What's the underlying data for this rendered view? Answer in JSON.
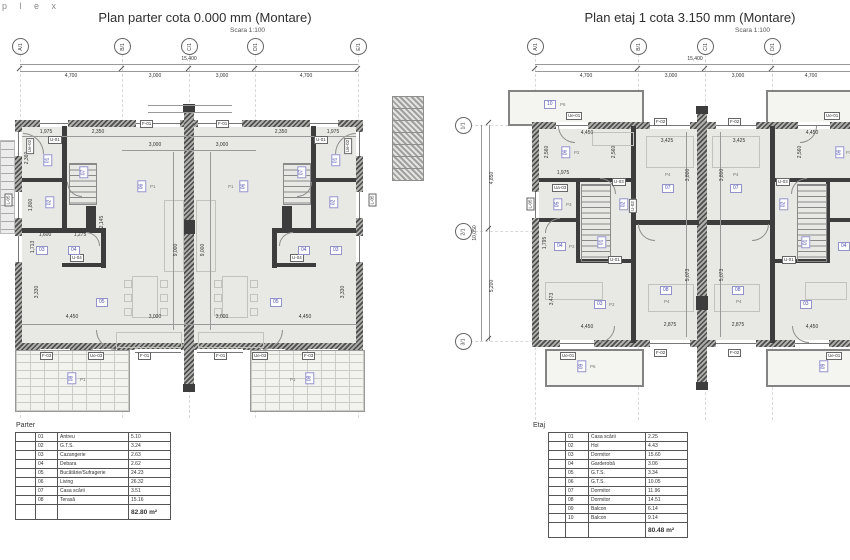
{
  "logo": "p l e x",
  "parter": {
    "title": "Plan parter cota 0.000 mm (Montare)",
    "scale": "Scara 1:100",
    "grid_letters": [
      "A/1",
      "B/1",
      "C/1",
      "D/1",
      "E/1"
    ],
    "total_dim": "15,400",
    "span_dims": [
      "4,700",
      "3,000",
      "3,000",
      "4,700"
    ],
    "top_dims": [
      "1,975",
      "2,350",
      "2,350",
      "1,975"
    ],
    "mid_dims": [
      "3,000",
      "3,000"
    ],
    "bottom_dims": [
      "4,450",
      "3,000",
      "3,000",
      "4,450"
    ],
    "v_dims": {
      "nine": "9,000",
      "t3330": "3,330",
      "t2360": "2,360",
      "t1800": "1,800",
      "t1713": "1,713",
      "t2145": "2,145"
    },
    "small_dims": [
      "1,600",
      "1,275"
    ],
    "tags": {
      "f01": "F-01",
      "f03": "F-03",
      "ue03": "Ue-03",
      "ue02": "Ue-02",
      "l05": "L-05",
      "u01": "U-01",
      "u04": "U-04"
    },
    "rooms": [
      "01",
      "02",
      "03",
      "04",
      "05",
      "06",
      "07",
      "08"
    ],
    "p1": "P1"
  },
  "etaj": {
    "title": "Plan etaj 1 cota 3.150 mm (Montare)",
    "scale": "Scara 1:100",
    "grid_letters": [
      "A/1",
      "B/1",
      "C/1",
      "D/1"
    ],
    "vgrid": {
      "labels": [
        "1/1",
        "2/1",
        "3/1"
      ],
      "total": "10,050",
      "spans": [
        "4,850",
        "5,200"
      ]
    },
    "total_dim": "15,400",
    "span_dims": [
      "4,700",
      "3,000",
      "3,000",
      "4,700"
    ],
    "top_dims": [
      "4,450",
      "3,425",
      "3,425",
      "4,450"
    ],
    "bottom_dims": [
      "4,450",
      "2,875",
      "2,875",
      "4,450"
    ],
    "v_dims": {
      "t2560": "2,560",
      "t3800": "3,800",
      "t5073": "5,073",
      "t3473": "3,473",
      "t1795": "1,795"
    },
    "small_dims": [
      "1,975"
    ],
    "tags": {
      "f02": "F-02",
      "ue01": "Ue-01",
      "l05": "L-05",
      "u01": "U-01",
      "u02": "U-02",
      "u03": "U-03",
      "ua03": "Ua-03"
    },
    "rooms": [
      "01",
      "02",
      "03",
      "04",
      "05",
      "06",
      "07",
      "08",
      "09",
      "10"
    ],
    "p": {
      "p2": "P2",
      "p3": "P3",
      "p4": "P4",
      "p6": "P6"
    }
  },
  "tables": {
    "parter": {
      "label": "Parter",
      "rows": [
        {
          "no": "01",
          "name": "Antreu",
          "area": "5.10"
        },
        {
          "no": "02",
          "name": "G.T.S.",
          "area": "3.24"
        },
        {
          "no": "03",
          "name": "Cazangerie",
          "area": "2.63"
        },
        {
          "no": "04",
          "name": "Debara",
          "area": "2.62"
        },
        {
          "no": "05",
          "name": "Bucătărie/Sufragerie",
          "area": "24.23"
        },
        {
          "no": "06",
          "name": "Living",
          "area": "26.32"
        },
        {
          "no": "07",
          "name": "Casa scării",
          "area": "3.51"
        },
        {
          "no": "08",
          "name": "Terasă",
          "area": "15.16"
        }
      ],
      "total": "82.80 m²"
    },
    "etaj": {
      "label": "Etaj",
      "rows": [
        {
          "no": "01",
          "name": "Casa scării",
          "area": "2.25"
        },
        {
          "no": "02",
          "name": "Hol",
          "area": "4.43"
        },
        {
          "no": "03",
          "name": "Dormitor",
          "area": "15.60"
        },
        {
          "no": "04",
          "name": "Garderobă",
          "area": "3.06"
        },
        {
          "no": "05",
          "name": "G.T.S.",
          "area": "3.34"
        },
        {
          "no": "06",
          "name": "G.T.S.",
          "area": "10.05"
        },
        {
          "no": "07",
          "name": "Dormitor",
          "area": "11.96"
        },
        {
          "no": "08",
          "name": "Dormitor",
          "area": "14.51"
        },
        {
          "no": "09",
          "name": "Balcon",
          "area": "6.14"
        },
        {
          "no": "10",
          "name": "Balcon",
          "area": "9.14"
        }
      ],
      "total": "80.48 m²"
    }
  }
}
